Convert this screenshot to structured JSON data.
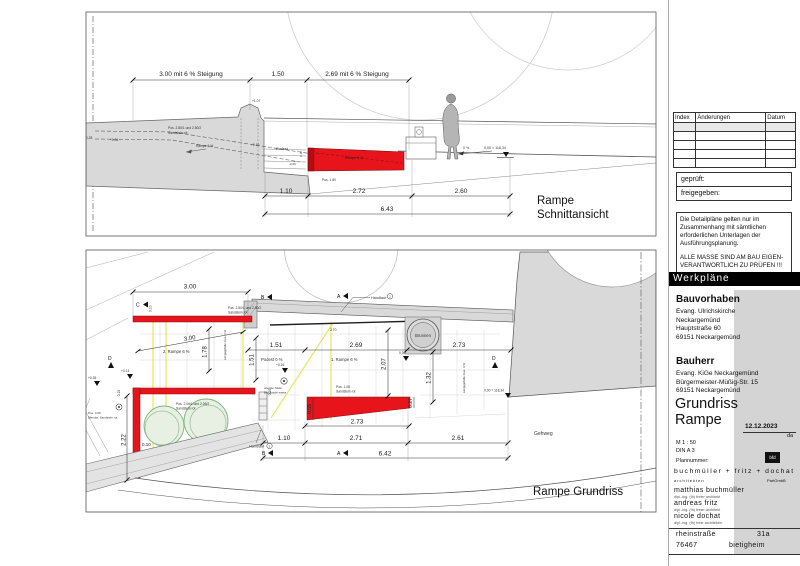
{
  "colors": {
    "red": "#e8141c",
    "dark_red": "#7d0f12",
    "gray": "#d9d9d9",
    "green": "#7fb57f",
    "yellow": "#e6e34f"
  },
  "section": {
    "title_1": "Rampe",
    "title_2": "Schnittansicht",
    "dim_top_1": "3.00  mit 6 % Steigung",
    "dim_top_2": "1.50",
    "dim_top_3": "2.69 mit 6 % Steigung",
    "dim_bot_1": "1.10",
    "dim_bot_2": "2.72",
    "dim_bot_3": "2.60",
    "dim_total": "6.43",
    "pos_wall_1": "Pos. 2.80/1  und 2.80/2",
    "pos_wall_2": "Sandstein rot",
    "hidden_ramp": "Rampe 6 %",
    "lvl_107": "+1.07",
    "lvl_028": "+0.28",
    "lvl_034": "+0.34",
    "lvl_016": "+0.16",
    "podest": "Podest",
    "dim_010": "0.10",
    "lvl_min026": "-0.26",
    "ramp_label": "Rampe 6 %",
    "pos_ramp": "Pos. 1.80",
    "slope": "0 %",
    "datum": "0,00 = 118,34"
  },
  "plan": {
    "title": "Rampe Grundriss",
    "dim_300_top": "3.00",
    "dim_010_top": "0.10",
    "dim_151": "1.51",
    "dim_269": "2.69",
    "dim_273": "2.73",
    "dim_300_diag": "3.00",
    "dim_178": "1.78",
    "dim_151_v": "1.51",
    "dim_207": "2.07",
    "dim_132": "1.32",
    "dim_055": "0.55",
    "dim_027": "0.27",
    "dim_222": "2.22",
    "dim_010_b": "0.10",
    "dim_010_c": "0.10",
    "dim_010_d": "0.10",
    "dim_110": "1.10",
    "dim_271": "2.71",
    "dim_261": "2.61",
    "dim_642": "6.42",
    "dim_273_b": "2.73",
    "dim_370": "3.70",
    "ramp1": "1. Rampe 6 %",
    "ramp2": "2. Rampe 6 %",
    "podest": "Podest 0 %",
    "handlauf": "Handlauf",
    "handlauf1_no": "1",
    "handlauf2_no": "2",
    "brunnen": "Brunnen",
    "gehweg": "Gehweg",
    "pos280_1": "Pos. 2.80/1 und 2.80/2",
    "pos280_2": "Sandstein rot",
    "pos206_1": "Pos. 2.06/1 und 2.06/2",
    "pos206_2": "Sandstein rot",
    "pos108_1": "Pos. 1.08",
    "pos108_2": "Sandstein rot",
    "pos306_1": "Pos. 3.06",
    "pos306_2": "Blendst. Sandstein rot",
    "stufe_1": "oberste Stufe",
    "stufe_2": "Blockstufe weiss",
    "laengs": "Längsgefälle max. 3 %",
    "lvl_014": "+0.14",
    "lvl_035": "+0.35",
    "lvl_016": "+0.16",
    "lvl_000": "0,00",
    "datum": "0,00 = 118,34",
    "mk_a": "A",
    "mk_b": "B",
    "mk_c": "C",
    "mk_d": "D"
  },
  "titleblock": {
    "revisions": {
      "col_index": "Index",
      "col_changes": "Änderungen",
      "col_date": "Datum"
    },
    "checked": "geprüft:",
    "released": "freigegeben:",
    "note1": "Die Detailpläne gelten nur im Zusammenhang mit sämtlichen erforderlichen Unterlagen der Ausführungsplanung.",
    "note2": "ALLE MASSE SIND AM BAU EIGEN-VERANTWORTLICH ZU PRÜFEN !!!",
    "category": "Werkpläne",
    "project_label": "Bauvorhaben",
    "project_lines": [
      "Evang. Ulrichskirche",
      "Neckargemünd",
      "Hauptstraße 60",
      "69151 Neckargemünd"
    ],
    "client_label": "Bauherr",
    "client_lines": [
      "Evang. KiGe Neckargemünd",
      "Bürgermeister-Müßig-Str. 15",
      "69151 Neckargemünd"
    ],
    "drawing_title_1": "Grundriss",
    "drawing_title_2": "Rampe",
    "date": "12.12.2023",
    "initials": "da",
    "scale": "M 1 : 50",
    "format": "DIN A 3",
    "plan_number_label": "Plannummer:",
    "logo": "bfd",
    "firm": "buchmüller + fritz + dochat",
    "firm_sub": "architekten",
    "firm_type": "PartGmbB",
    "partners": [
      {
        "name": "matthias buchmüller",
        "title": "dipl.-ing. (fh) freier architekt"
      },
      {
        "name": "andreas fritz",
        "title": "dipl.-ing. (fh) freier architekt"
      },
      {
        "name": "nicole dochat",
        "title": "dipl.-ing. (fh) freie architektin"
      }
    ],
    "address_street": "rheinstraße",
    "address_no": "31a",
    "address_zip": "76467",
    "address_city": "bietigheim"
  }
}
